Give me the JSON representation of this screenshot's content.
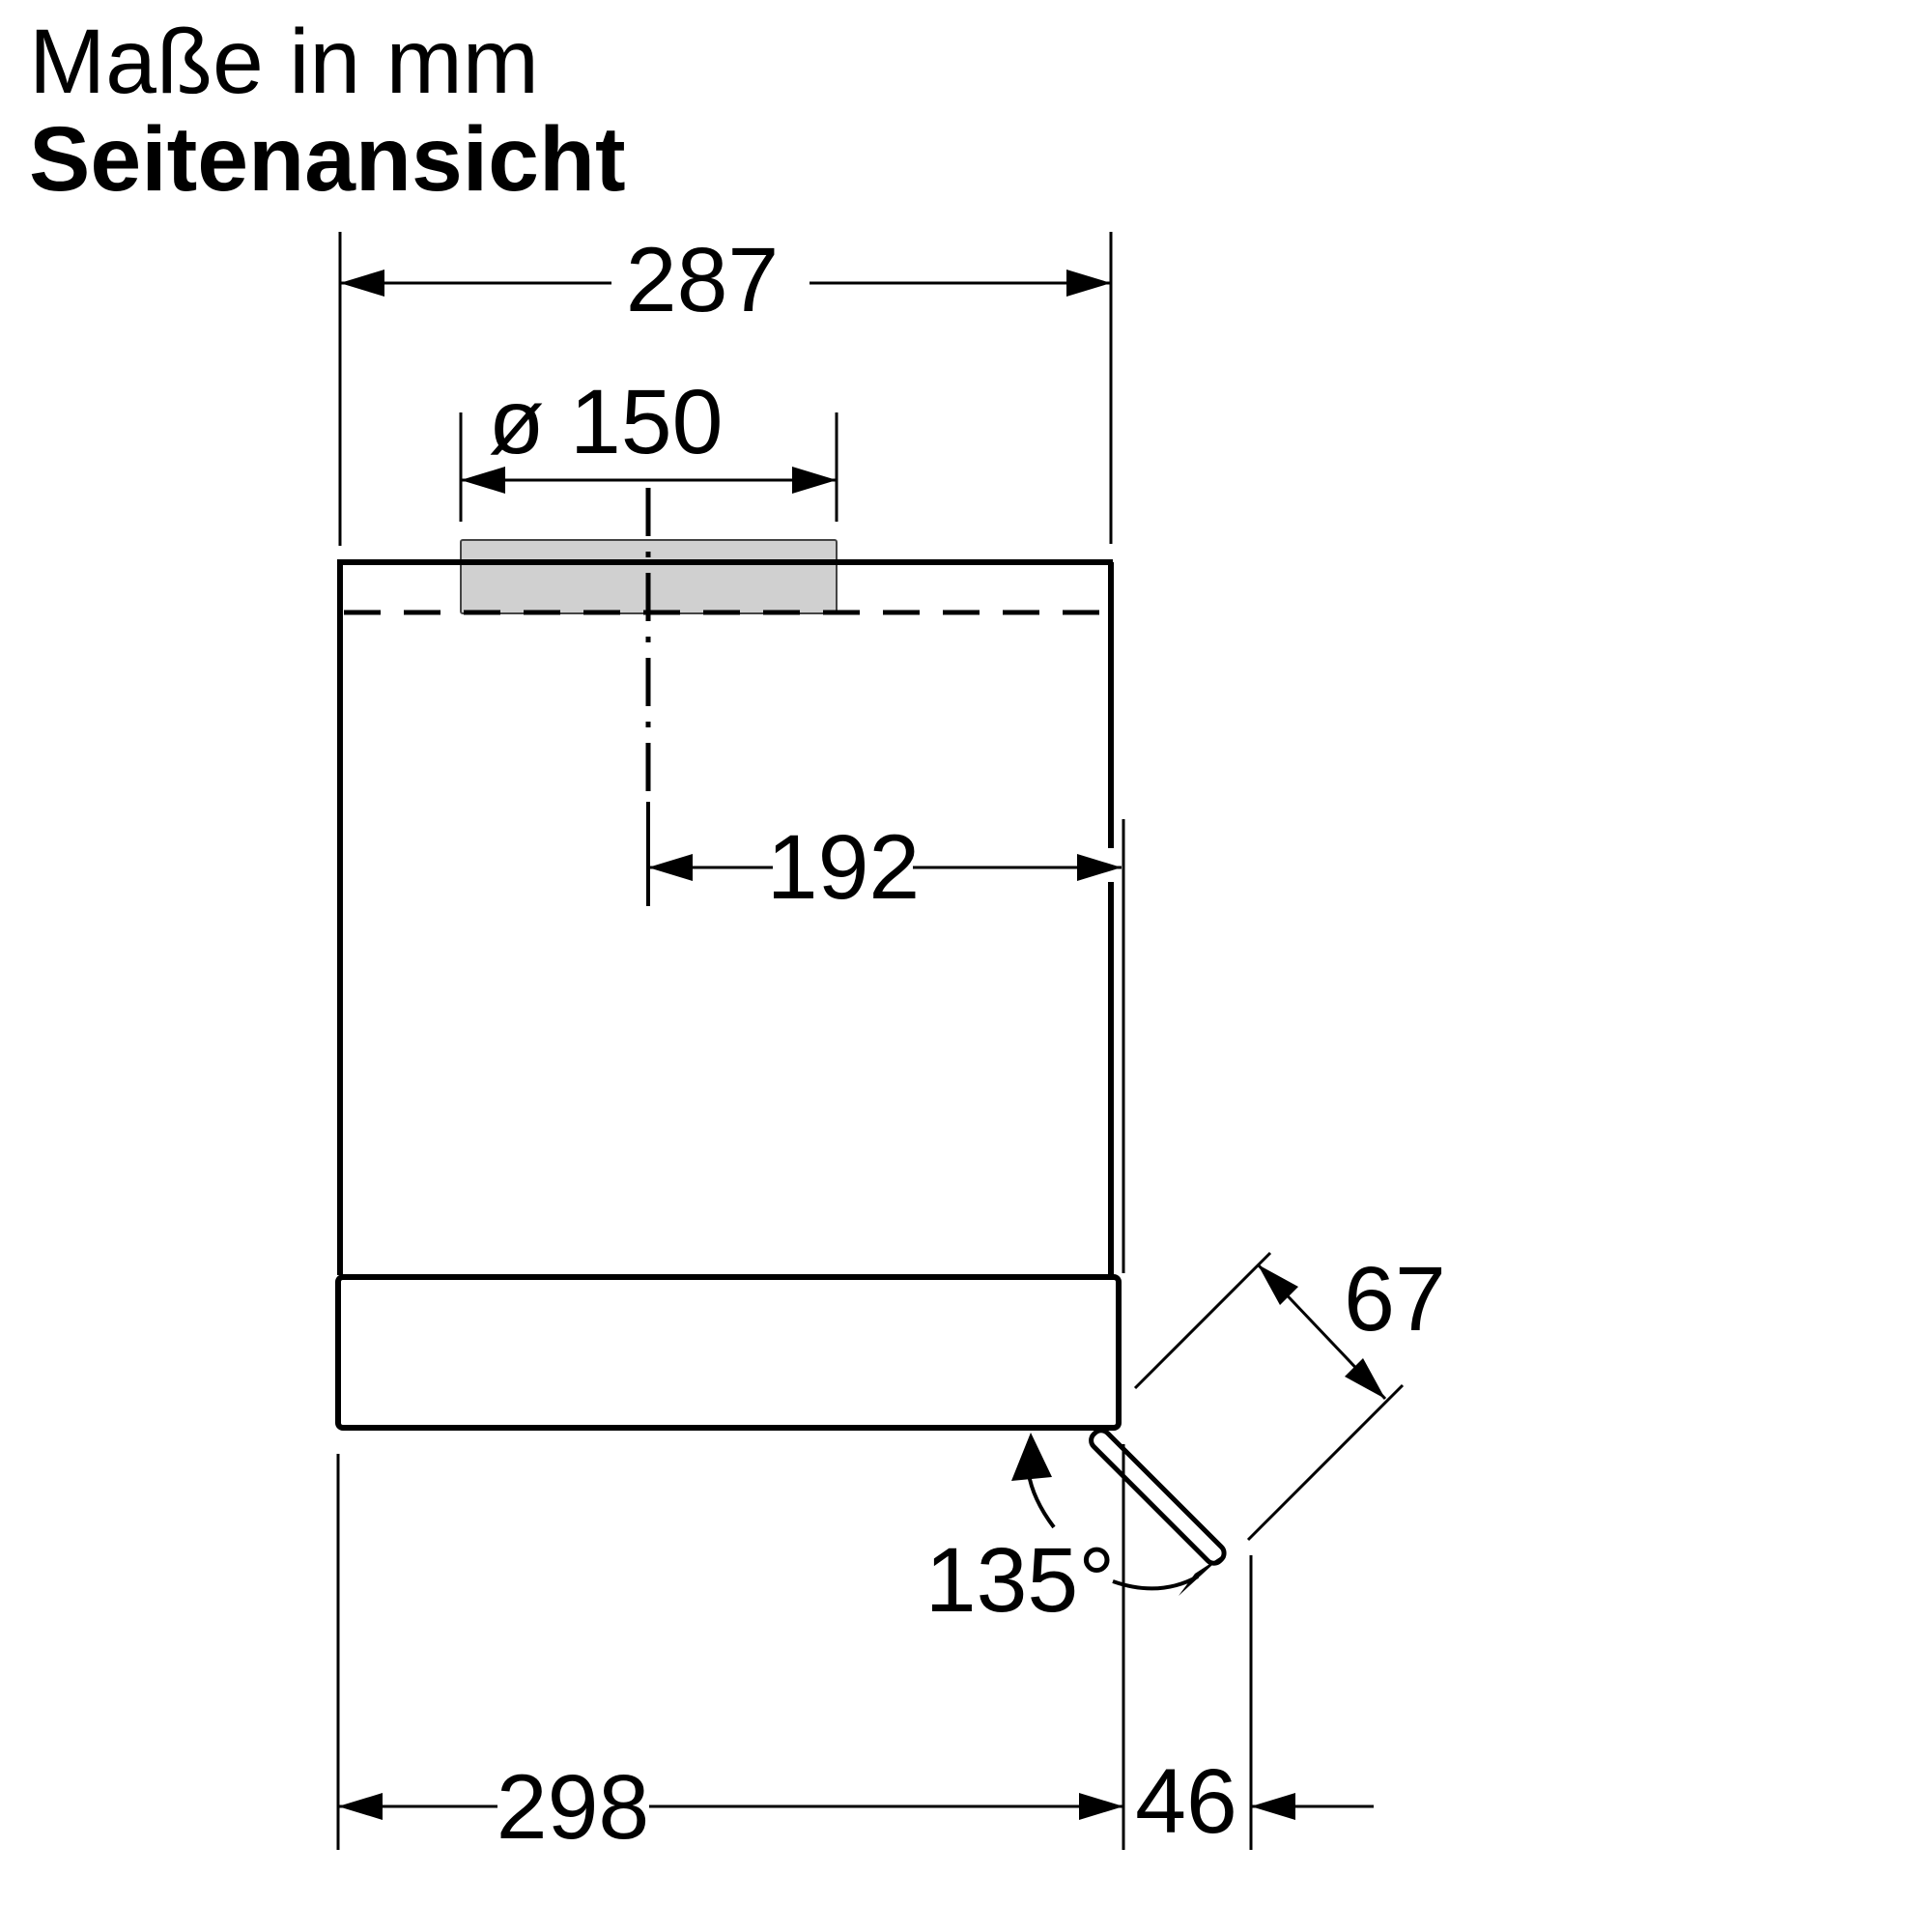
{
  "title": {
    "line1": "Maße in mm",
    "line2": "Seitenansicht"
  },
  "dimensions": {
    "top_width": "287",
    "duct_diameter": "ø 150",
    "center_to_right": "192",
    "flap_length": "67",
    "flap_angle": "135°",
    "bottom_width": "298",
    "flap_offset": "46"
  },
  "colors": {
    "line": "#000000",
    "collar_fill": "#d0d0d0",
    "background": "#ffffff"
  }
}
